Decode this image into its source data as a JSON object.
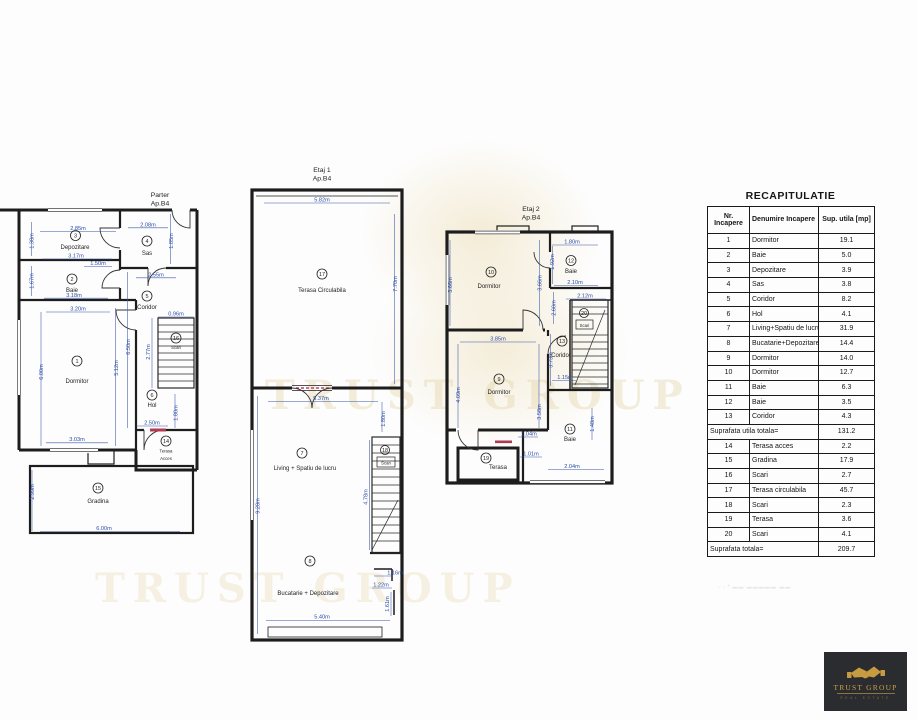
{
  "colors": {
    "wall_black": "#1d1d1d",
    "dimension_blue": "#2d4da6",
    "accent_red": "#b03a50",
    "watermark_gold": "#e0cda0",
    "logo_gold": "#c79b3f",
    "logo_bg": "#2a2c30"
  },
  "watermark": {
    "text": "TRUST GROUP"
  },
  "logo": {
    "title": "TRUST GROUP",
    "subtitle": "REAL ESTATE",
    "icon": "handshake-icon"
  },
  "recap": {
    "title": "RECAPITULATIE",
    "col_nr": "Nr. Incapere",
    "col_name": "Denumire Incapere",
    "col_area": "Sup. utila [mp]",
    "rows": [
      {
        "nr": "1",
        "name": "Dormitor",
        "area": "19.1"
      },
      {
        "nr": "2",
        "name": "Baie",
        "area": "5.0"
      },
      {
        "nr": "3",
        "name": "Depozitare",
        "area": "3.9"
      },
      {
        "nr": "4",
        "name": "Sas",
        "area": "3.8"
      },
      {
        "nr": "5",
        "name": "Coridor",
        "area": "8.2"
      },
      {
        "nr": "6",
        "name": "Hol",
        "area": "4.1"
      },
      {
        "nr": "7",
        "name": "Living+Spatiu de lucru",
        "area": "31.9"
      },
      {
        "nr": "8",
        "name": "Bucatarie+Depozitare",
        "area": "14.4"
      },
      {
        "nr": "9",
        "name": "Dormitor",
        "area": "14.0"
      },
      {
        "nr": "10",
        "name": "Dormitor",
        "area": "12.7"
      },
      {
        "nr": "11",
        "name": "Baie",
        "area": "6.3"
      },
      {
        "nr": "12",
        "name": "Baie",
        "area": "3.5"
      },
      {
        "nr": "13",
        "name": "Coridor",
        "area": "4.3"
      }
    ],
    "subtotal_label": "Suprafata utila totala=",
    "subtotal_value": "131.2",
    "rows2": [
      {
        "nr": "14",
        "name": "Terasa acces",
        "area": "2.2"
      },
      {
        "nr": "15",
        "name": "Gradina",
        "area": "17.9"
      },
      {
        "nr": "16",
        "name": "Scari",
        "area": "2.7"
      },
      {
        "nr": "17",
        "name": "Terasa circulabila",
        "area": "45.7"
      },
      {
        "nr": "18",
        "name": "Scari",
        "area": "2.3"
      },
      {
        "nr": "19",
        "name": "Terasa",
        "area": "3.6"
      },
      {
        "nr": "20",
        "name": "Scari",
        "area": "4.1"
      }
    ],
    "total_label": "Suprafata totala=",
    "total_value": "209.7",
    "footnote": "· · ' —— ————— ——"
  },
  "plans": {
    "parter": {
      "title": "Parter",
      "ap": "Ap.B4",
      "rooms": {
        "r1": {
          "n": "1",
          "label": "Dormitor"
        },
        "r2": {
          "n": "2",
          "label": "Baie"
        },
        "r3": {
          "n": "3",
          "label": "Depozitare"
        },
        "r4": {
          "n": "4",
          "label": "Sas"
        },
        "r5": {
          "n": "5",
          "label": "Coridor"
        },
        "r6": {
          "n": "6",
          "label": "Hol"
        },
        "r14": {
          "n": "14",
          "label1": "Terasa",
          "label2": "Acces"
        },
        "r15": {
          "n": "15",
          "label": "Gradina"
        },
        "r16": {
          "n": "16",
          "label": "Scari"
        }
      },
      "dims": {
        "dep_w": "2.85m",
        "dep_h": "1.38m",
        "dep_w2": "3.17m",
        "sas_w": "2.08m",
        "sas_h": "1.85m",
        "baie_w": "1.50m",
        "baie_h": "1.67m",
        "baie_w2": "3.18m",
        "dorm_w": "3.20m",
        "dorm_hl": "6.00m",
        "dorm_hr": "5.12m",
        "dorm_w2": "3.03m",
        "cor_w": "2.55m",
        "cor_h": "6.50m",
        "scari_w": "0.96m",
        "scari_h": "2.77m",
        "hol_h": "1.80m",
        "hol_w": "2.50m",
        "grad_h": "2.99m",
        "grad_w": "6.00m"
      }
    },
    "etaj1": {
      "title": "Etaj 1",
      "ap": "Ap.B4",
      "rooms": {
        "r17": {
          "n": "17",
          "label": "Terasa Circulabila"
        },
        "r7": {
          "n": "7",
          "label": "Living + Spatiu de lucru"
        },
        "r18": {
          "n": "18",
          "label": "Scari"
        },
        "r8": {
          "n": "8",
          "label": "Bucatarie + Depozitare"
        }
      },
      "dims": {
        "ter_w": "5.82m",
        "ter_h": "7.70m",
        "liv_w": "5.37m",
        "liv_h": "1.80m",
        "left_h": "9.28m",
        "scari_h": "4.78m",
        "b1": "1.16m",
        "b2": "1.22m",
        "b3": "1.61m",
        "buc_w": "5.40m"
      }
    },
    "etaj2": {
      "title": "Etaj 2",
      "ap": "Ap.B4",
      "rooms": {
        "r10": {
          "n": "10",
          "label": "Dormitor"
        },
        "r12": {
          "n": "12",
          "label": "Baie"
        },
        "r20": {
          "n": "20",
          "label": "Scari"
        },
        "r13": {
          "n": "13",
          "label": "Coridor"
        },
        "r9": {
          "n": "9",
          "label": "Dormitor"
        },
        "r11": {
          "n": "11",
          "label": "Baie"
        },
        "r19": {
          "n": "19",
          "label": "Terasa"
        }
      },
      "dims": {
        "b12_w": "1.80m",
        "b12_h": "1.92m",
        "b12_w2": "2.10m",
        "d10_hl": "3.66m",
        "d10_hr": "3.66m",
        "sc_w": "2.12m",
        "mid_h": "2.60m",
        "cor_h": "3.73m",
        "d9_w": "3.85m",
        "d9_hl": "4.09m",
        "d9_hr": "3.58m",
        "cor_w": "1.15m",
        "t1": "1.04m",
        "t2": "1.01m",
        "b11_h": "1.48m",
        "bot_w": "2.04m"
      }
    }
  }
}
